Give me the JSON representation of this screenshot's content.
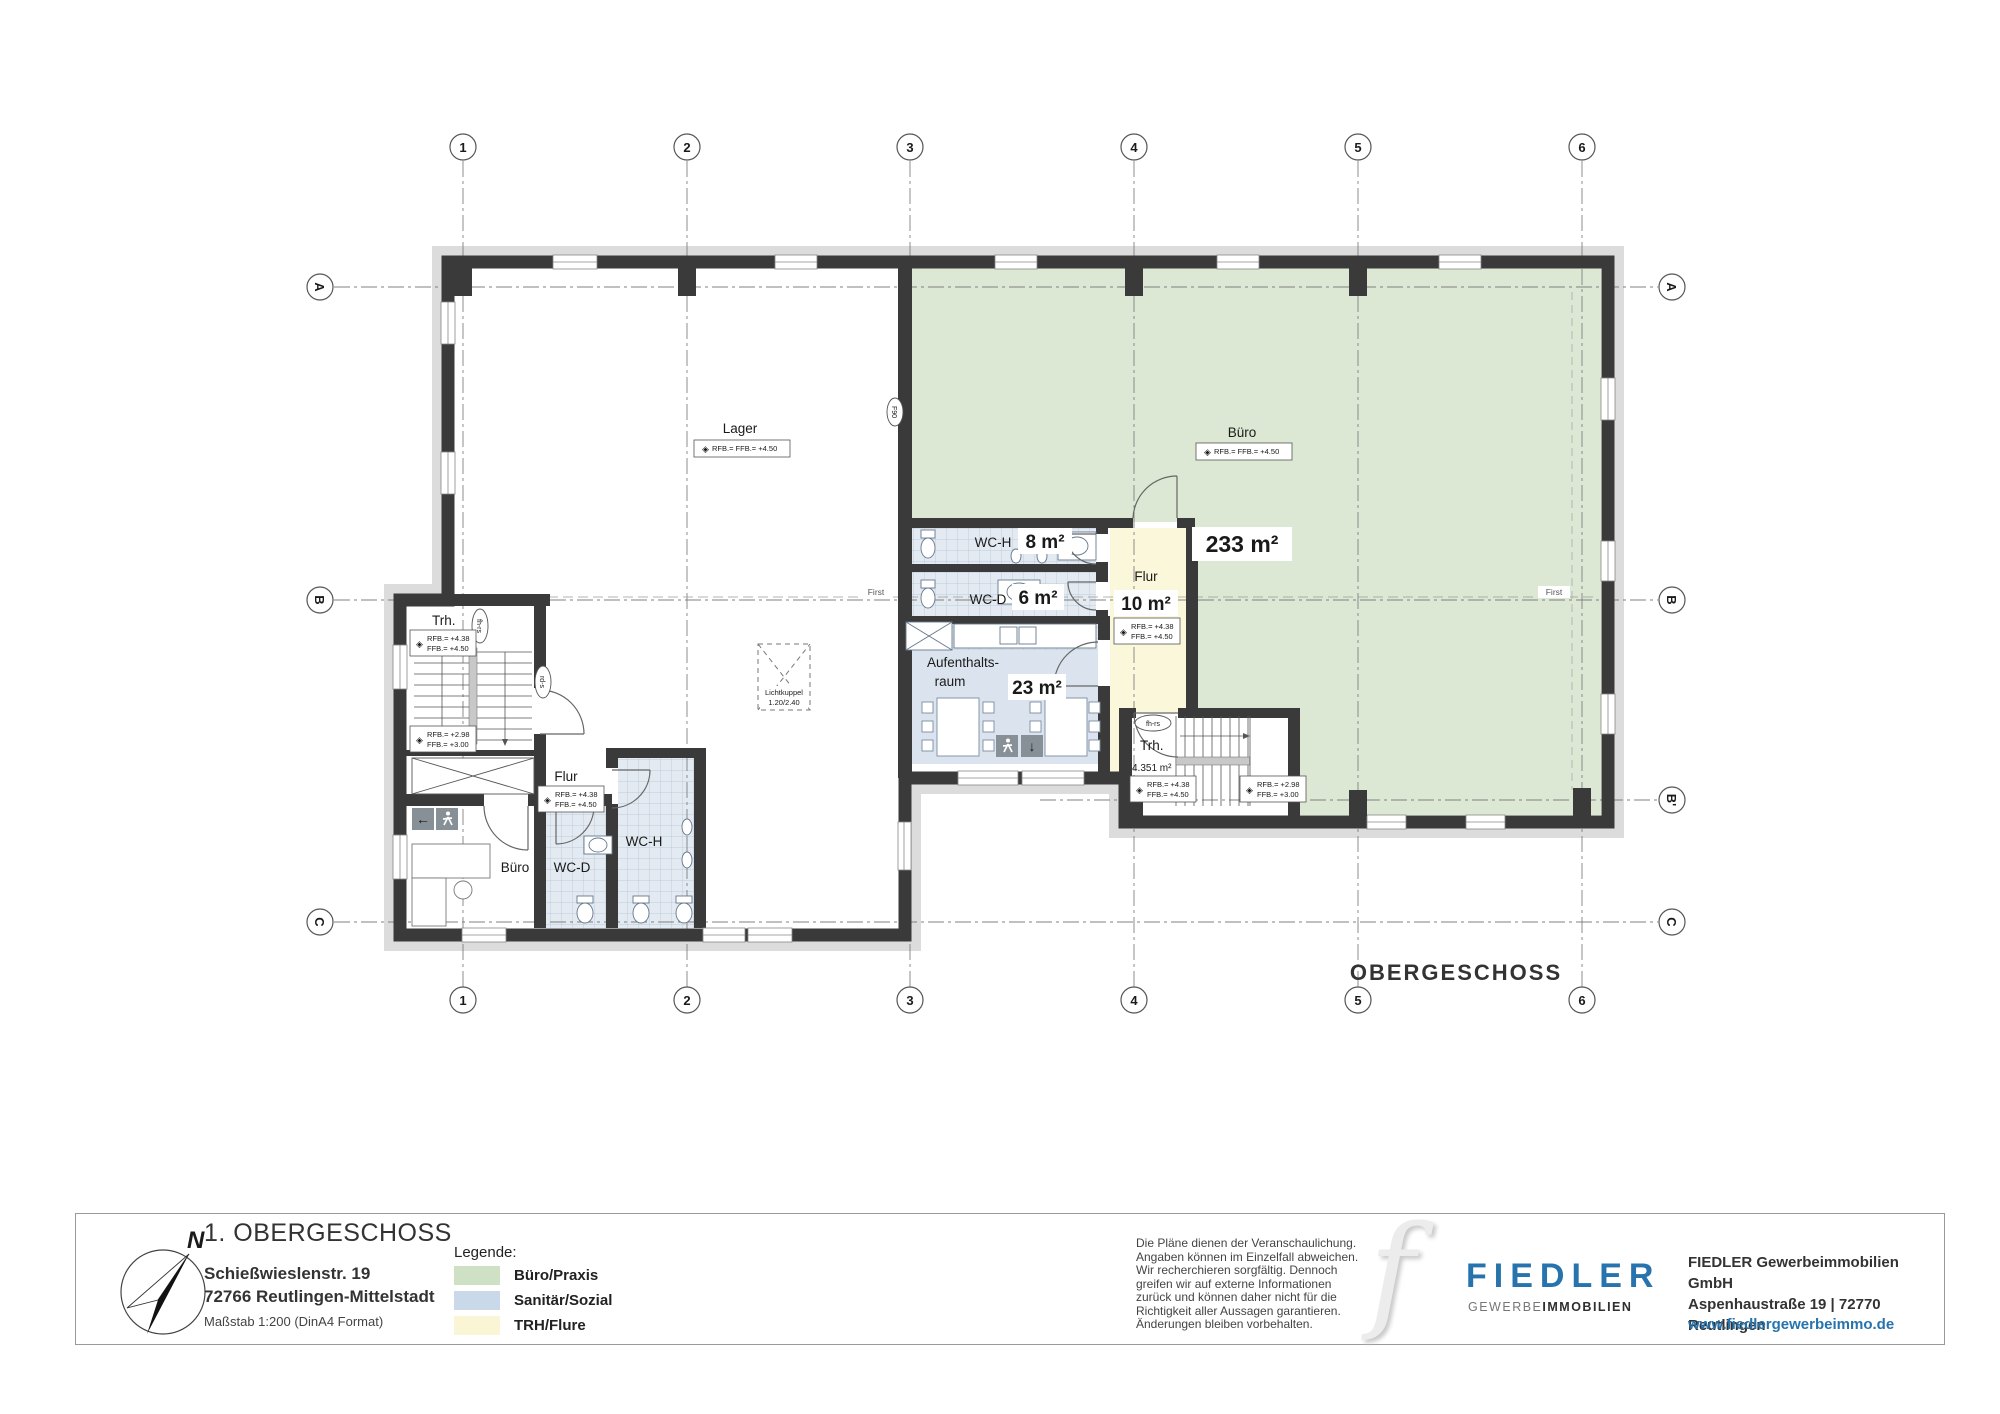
{
  "page": {
    "floor_label": "OBERGESCHOSS"
  },
  "colors": {
    "brand_blue": "#2673ad",
    "wall": "#3a3a3a",
    "band": "#dcdcdc",
    "room_green": "#dce8d3",
    "room_blue": "#dbe4ee",
    "room_tile": "#e3eaf1",
    "room_yellow": "#faf7da",
    "legend_green": "#cfe1c5",
    "legend_blue": "#c9d9ea",
    "legend_yellow": "#faf6d5"
  },
  "grid": {
    "cols": [
      "1",
      "2",
      "3",
      "4",
      "5",
      "6"
    ],
    "rows": [
      "A",
      "B",
      "B'",
      "C"
    ]
  },
  "plan": {
    "rooms": {
      "lager": "Lager",
      "buero_main": {
        "name": "Büro",
        "area": "233 m²"
      },
      "wch_main": {
        "name": "WC-H",
        "area": "8 m²"
      },
      "wcd_main": {
        "name": "WC-D",
        "area": "6 m²"
      },
      "flur_main": {
        "name": "Flur",
        "area": "10 m²"
      },
      "aufenthaltsraum": {
        "name_line1": "Aufenthalts-",
        "name_line2": "raum",
        "area": "23 m²"
      },
      "trh_right": {
        "name": "Trh.",
        "area": "4.351 m²"
      },
      "trh_left": {
        "name": "Trh."
      },
      "flur_lower": "Flur",
      "buero_lower": "Büro",
      "wcd_lower": "WC-D",
      "wch_lower": "WC-H"
    },
    "levels": {
      "marker": "◈",
      "combined": "RFB.= FFB.= +4.50",
      "rfb_438": "RFB.= +4.38",
      "ffb_450": "FFB.= +4.50",
      "rfb_298": "RFB.= +2.98",
      "ffb_300": "FFB.= +3.00"
    },
    "doors": {
      "fh_rs": "fh-rs",
      "rd_s": "rd-s",
      "f90": "F90"
    },
    "icons": {
      "arrow_left": "←",
      "arrow_down": "↓"
    },
    "lichtkuppel": {
      "line1": "Lichtkuppel",
      "line2": "1.20/2.40"
    },
    "ridge_label": "First"
  },
  "titleblock": {
    "title": "1. OBERGESCHOSS",
    "address1": "Schießwieslenstr. 19",
    "address2": "72766 Reutlingen-Mittelstadt",
    "scale": "Maßstab 1:200 (DinA4 Format)",
    "compass_n": "N",
    "legend": {
      "heading": "Legende:",
      "items": [
        {
          "label": "Büro/Praxis"
        },
        {
          "label": "Sanitär/Sozial"
        },
        {
          "label": "TRH/Flure"
        }
      ]
    },
    "disclaimer": [
      "Die Pläne dienen der Veranschaulichung.",
      "Angaben können im Einzelfall abweichen.",
      "Wir recherchieren sorgfältig. Dennoch",
      "greifen wir auf externe Informationen",
      "zurück und können daher nicht für die",
      "Richtigkeit aller Aussagen garantieren.",
      "Änderungen bleiben vorbehalten."
    ],
    "logo": {
      "f": "f",
      "name": "FIEDLER",
      "sub1": "GEWERBE",
      "sub2": "IMMOBILIEN"
    },
    "company1": "FIEDLER Gewerbeimmobilien GmbH",
    "company2": "Aspenhaustraße 19 | 72770 Reutlingen",
    "website": "www.fiedlergewerbeimmo.de"
  }
}
